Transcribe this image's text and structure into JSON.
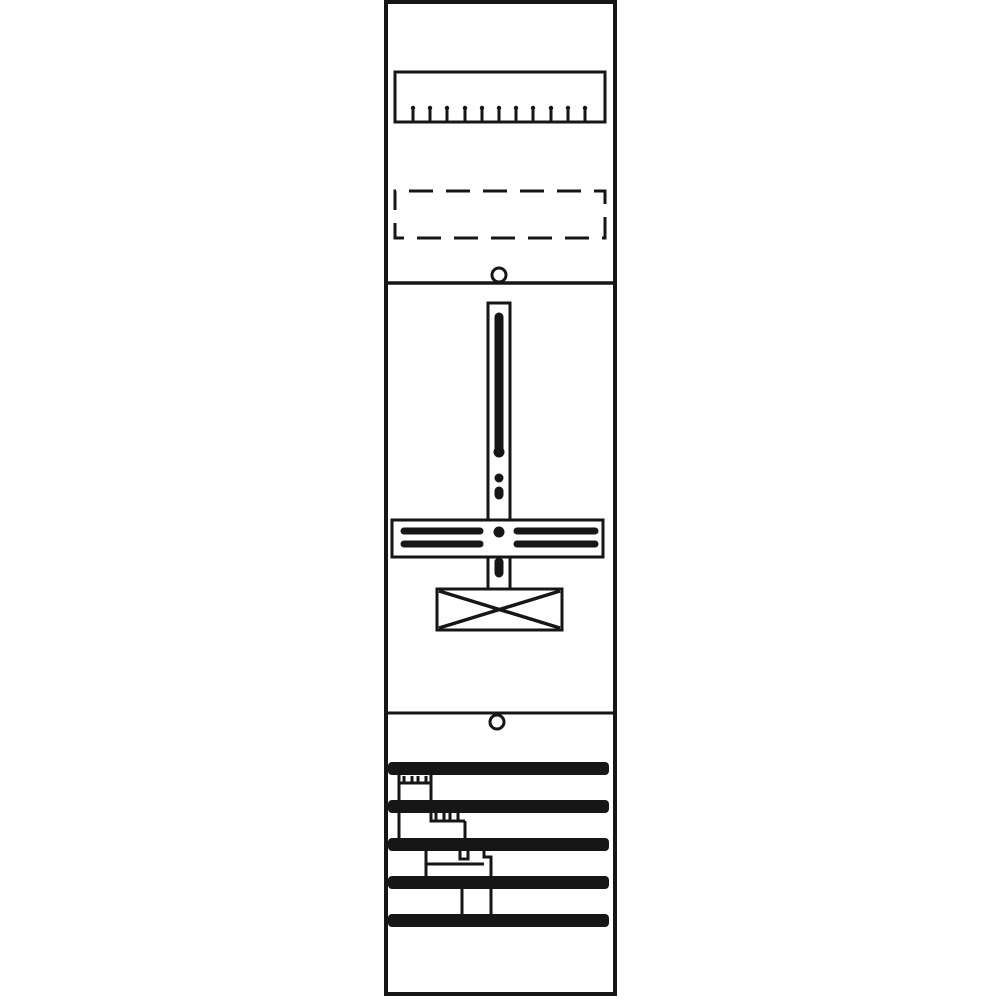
{
  "diagram": {
    "description": "Technical line drawing of a one-field meter mounting panel: terminal comb strip, dashed reserve slot, screw holes, vertical meter cross-rail with slotted crossbar, crossed junction box, and five horizontal busbars joined by terminal clamps and wires",
    "ink": "#161616",
    "paper": "#ffffff"
  },
  "shapes": {
    "rects": [
      {
        "name": "panel-border",
        "x": 386,
        "y": 2,
        "w": 229,
        "h": 992,
        "sw": 4
      },
      {
        "name": "terminal-strip-body",
        "x": 395,
        "y": 72,
        "w": 210,
        "h": 50,
        "sw": 3
      },
      {
        "name": "reserve-slot-dashed",
        "x": 395,
        "y": 191,
        "w": 210,
        "h": 47,
        "sw": 3,
        "dash": "24 13",
        "dashoff": -14
      },
      {
        "name": "mounting-rail-upper",
        "x": 488,
        "y": 303,
        "w": 22,
        "h": 217,
        "sw": 3
      },
      {
        "name": "meter-crossbar",
        "x": 392,
        "y": 520,
        "w": 211,
        "h": 37,
        "sw": 3
      },
      {
        "name": "mounting-rail-lower",
        "x": 488,
        "y": 557,
        "w": 22,
        "h": 32,
        "sw": 3
      },
      {
        "name": "junction-box",
        "x": 437,
        "y": 589,
        "w": 125,
        "h": 41,
        "sw": 3
      },
      {
        "name": "busbar-1",
        "x": 388,
        "y": 762,
        "w": 221,
        "h": 13,
        "rx": 4,
        "fill": "ink"
      },
      {
        "name": "busbar-2",
        "x": 388,
        "y": 800,
        "w": 221,
        "h": 13,
        "rx": 4,
        "fill": "ink"
      },
      {
        "name": "busbar-3",
        "x": 388,
        "y": 838,
        "w": 221,
        "h": 13,
        "rx": 4,
        "fill": "ink"
      },
      {
        "name": "busbar-4",
        "x": 388,
        "y": 876,
        "w": 221,
        "h": 13,
        "rx": 4,
        "fill": "ink"
      },
      {
        "name": "busbar-5",
        "x": 388,
        "y": 914,
        "w": 221,
        "h": 13,
        "rx": 4,
        "fill": "ink"
      }
    ],
    "lines": [
      {
        "name": "section-divider-top",
        "x1": 386,
        "y1": 283,
        "x2": 615,
        "y2": 283,
        "sw": 3.5
      },
      {
        "name": "section-divider-bottom",
        "x1": 386,
        "y1": 713,
        "x2": 615,
        "y2": 713,
        "sw": 3
      },
      {
        "name": "ruler-tick",
        "x1": 413,
        "y1": 120,
        "x2": 413,
        "y2": 109,
        "sw": 3,
        "cap": "round"
      },
      {
        "name": "ruler-tick",
        "x1": 430,
        "y1": 120,
        "x2": 430,
        "y2": 109,
        "sw": 3,
        "cap": "round"
      },
      {
        "name": "ruler-tick",
        "x1": 447,
        "y1": 120,
        "x2": 447,
        "y2": 109,
        "sw": 3,
        "cap": "round"
      },
      {
        "name": "ruler-tick",
        "x1": 465,
        "y1": 120,
        "x2": 465,
        "y2": 109,
        "sw": 3,
        "cap": "round"
      },
      {
        "name": "ruler-tick",
        "x1": 482,
        "y1": 120,
        "x2": 482,
        "y2": 109,
        "sw": 3,
        "cap": "round"
      },
      {
        "name": "ruler-tick",
        "x1": 499,
        "y1": 120,
        "x2": 499,
        "y2": 109,
        "sw": 3,
        "cap": "round"
      },
      {
        "name": "ruler-tick",
        "x1": 516,
        "y1": 120,
        "x2": 516,
        "y2": 109,
        "sw": 3,
        "cap": "round"
      },
      {
        "name": "ruler-tick",
        "x1": 533,
        "y1": 120,
        "x2": 533,
        "y2": 109,
        "sw": 3,
        "cap": "round"
      },
      {
        "name": "ruler-tick",
        "x1": 551,
        "y1": 120,
        "x2": 551,
        "y2": 109,
        "sw": 3,
        "cap": "round"
      },
      {
        "name": "ruler-tick",
        "x1": 568,
        "y1": 120,
        "x2": 568,
        "y2": 109,
        "sw": 3,
        "cap": "round"
      },
      {
        "name": "ruler-tick",
        "x1": 585,
        "y1": 120,
        "x2": 585,
        "y2": 109,
        "sw": 3,
        "cap": "round"
      },
      {
        "name": "rail-slot-long",
        "x1": 499,
        "y1": 317,
        "x2": 499,
        "y2": 450,
        "sw": 9,
        "cap": "round"
      },
      {
        "name": "rail-slot-short",
        "x1": 499,
        "y1": 491,
        "x2": 499,
        "y2": 495,
        "sw": 9,
        "cap": "round"
      },
      {
        "name": "rail-slot-lower",
        "x1": 499,
        "y1": 562,
        "x2": 499,
        "y2": 573,
        "sw": 9,
        "cap": "round"
      },
      {
        "name": "crossbar-slot-left-upper",
        "x1": 404,
        "y1": 531,
        "x2": 480,
        "y2": 531,
        "sw": 7,
        "cap": "round"
      },
      {
        "name": "crossbar-slot-left-lower",
        "x1": 404,
        "y1": 544,
        "x2": 480,
        "y2": 544,
        "sw": 7,
        "cap": "round"
      },
      {
        "name": "crossbar-slot-right-upper",
        "x1": 517,
        "y1": 531,
        "x2": 595,
        "y2": 531,
        "sw": 7,
        "cap": "round"
      },
      {
        "name": "crossbar-slot-right-lower",
        "x1": 517,
        "y1": 544,
        "x2": 595,
        "y2": 544,
        "sw": 7,
        "cap": "round"
      },
      {
        "name": "junction-box-diagonal-1",
        "x1": 439,
        "y1": 591,
        "x2": 560,
        "y2": 628,
        "sw": 3.5
      },
      {
        "name": "junction-box-diagonal-2",
        "x1": 560,
        "y1": 591,
        "x2": 439,
        "y2": 628,
        "sw": 3.5
      }
    ],
    "circles": [
      {
        "name": "screw-hole-top",
        "cx": 499,
        "cy": 275,
        "r": 7,
        "sw": 3,
        "fill": "paper"
      },
      {
        "name": "screw-hole-bottom",
        "cx": 497,
        "cy": 722,
        "r": 7,
        "sw": 3,
        "fill": "paper"
      },
      {
        "name": "ruler-tick-head",
        "cx": 413,
        "cy": 108,
        "r": 2.2,
        "fill": "ink"
      },
      {
        "name": "ruler-tick-head",
        "cx": 430,
        "cy": 108,
        "r": 2.2,
        "fill": "ink"
      },
      {
        "name": "ruler-tick-head",
        "cx": 447,
        "cy": 108,
        "r": 2.2,
        "fill": "ink"
      },
      {
        "name": "ruler-tick-head",
        "cx": 465,
        "cy": 108,
        "r": 2.2,
        "fill": "ink"
      },
      {
        "name": "ruler-tick-head",
        "cx": 482,
        "cy": 108,
        "r": 2.2,
        "fill": "ink"
      },
      {
        "name": "ruler-tick-head",
        "cx": 499,
        "cy": 108,
        "r": 2.2,
        "fill": "ink"
      },
      {
        "name": "ruler-tick-head",
        "cx": 516,
        "cy": 108,
        "r": 2.2,
        "fill": "ink"
      },
      {
        "name": "ruler-tick-head",
        "cx": 533,
        "cy": 108,
        "r": 2.2,
        "fill": "ink"
      },
      {
        "name": "ruler-tick-head",
        "cx": 551,
        "cy": 108,
        "r": 2.2,
        "fill": "ink"
      },
      {
        "name": "ruler-tick-head",
        "cx": 568,
        "cy": 108,
        "r": 2.2,
        "fill": "ink"
      },
      {
        "name": "ruler-tick-head",
        "cx": 585,
        "cy": 108,
        "r": 2.2,
        "fill": "ink"
      },
      {
        "name": "rail-slot-end-bulge",
        "cx": 499,
        "cy": 452,
        "r": 5.5,
        "fill": "ink"
      },
      {
        "name": "rail-dot",
        "cx": 499,
        "cy": 478,
        "r": 4.5,
        "fill": "ink"
      },
      {
        "name": "crossbar-center-dot",
        "cx": 499,
        "cy": 532,
        "r": 5.5,
        "fill": "ink"
      }
    ],
    "paths": [
      {
        "name": "wire-bar1-to-bar3",
        "d": "M399,774 V839",
        "sw": 3
      },
      {
        "name": "wire-bar1-to-bar2",
        "d": "M431,774 V801",
        "sw": 3
      },
      {
        "name": "clamp-bar1-baseline",
        "d": "M399,783 H431",
        "sw": 3
      },
      {
        "name": "clamp-bar1-notch",
        "d": "M404,776 v7 h8 v-7",
        "sw": 3
      },
      {
        "name": "clamp-bar1-notch",
        "d": "M418,776 v7 h8 v-7",
        "sw": 3
      },
      {
        "name": "clamp-bar2-baseline",
        "d": "M431,812 V821 H465",
        "sw": 3
      },
      {
        "name": "clamp-bar2-notch",
        "d": "M436,813 v8 h8 v-8",
        "sw": 3
      },
      {
        "name": "clamp-bar2-notch",
        "d": "M450,813 v8 h8 v-8",
        "sw": 3
      },
      {
        "name": "wire-bar2-to-bar3",
        "d": "M465,821 V839",
        "sw": 3
      },
      {
        "name": "wire-bar3-to-bar4",
        "d": "M426,850 V877",
        "sw": 3
      },
      {
        "name": "clamp-bar3-baseline",
        "d": "M426,864 H484",
        "sw": 3
      },
      {
        "name": "clamp-bar3-notch",
        "d": "M460,851 v8 h8 v-8",
        "sw": 3
      },
      {
        "name": "clamp-bar3-step-and-wire-to-bar5",
        "d": "M484,851 v6 h7 v58",
        "sw": 3
      },
      {
        "name": "wire-bar4-to-bar5",
        "d": "M462,888 V915",
        "sw": 3
      }
    ]
  }
}
